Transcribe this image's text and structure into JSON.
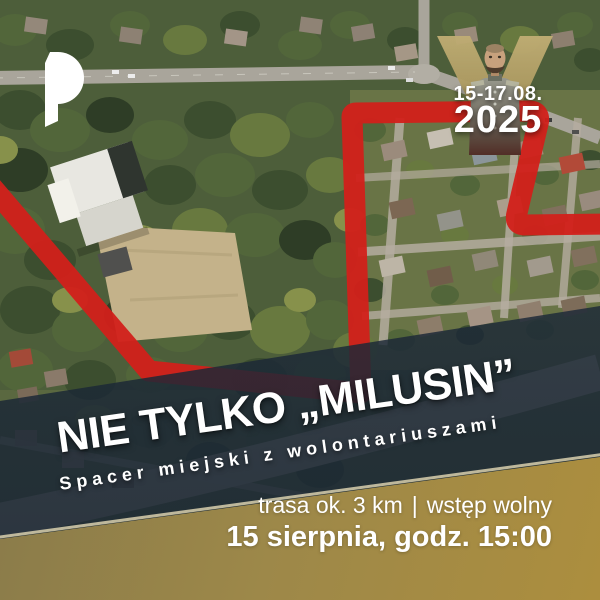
{
  "poster": {
    "logo": {
      "icon": "jp-monogram"
    },
    "badge": {
      "dates": "15-17.08.",
      "year": "2025",
      "figure": "pilsudski-portrait",
      "v_color": "#b3a065"
    },
    "title": "NIE TYLKO „MILUSIN”",
    "subtitle": "Spacer miejski z wolontariuszami",
    "info": {
      "route": "trasa ok. 3 km",
      "separator": "|",
      "admission": "wstęp wolny",
      "datetime": "15 sierpnia, godz. 15:00"
    },
    "map": {
      "route_color": "#d2201a",
      "band_dark": "#2c3e50",
      "band_gold": "#a98c3e"
    }
  }
}
